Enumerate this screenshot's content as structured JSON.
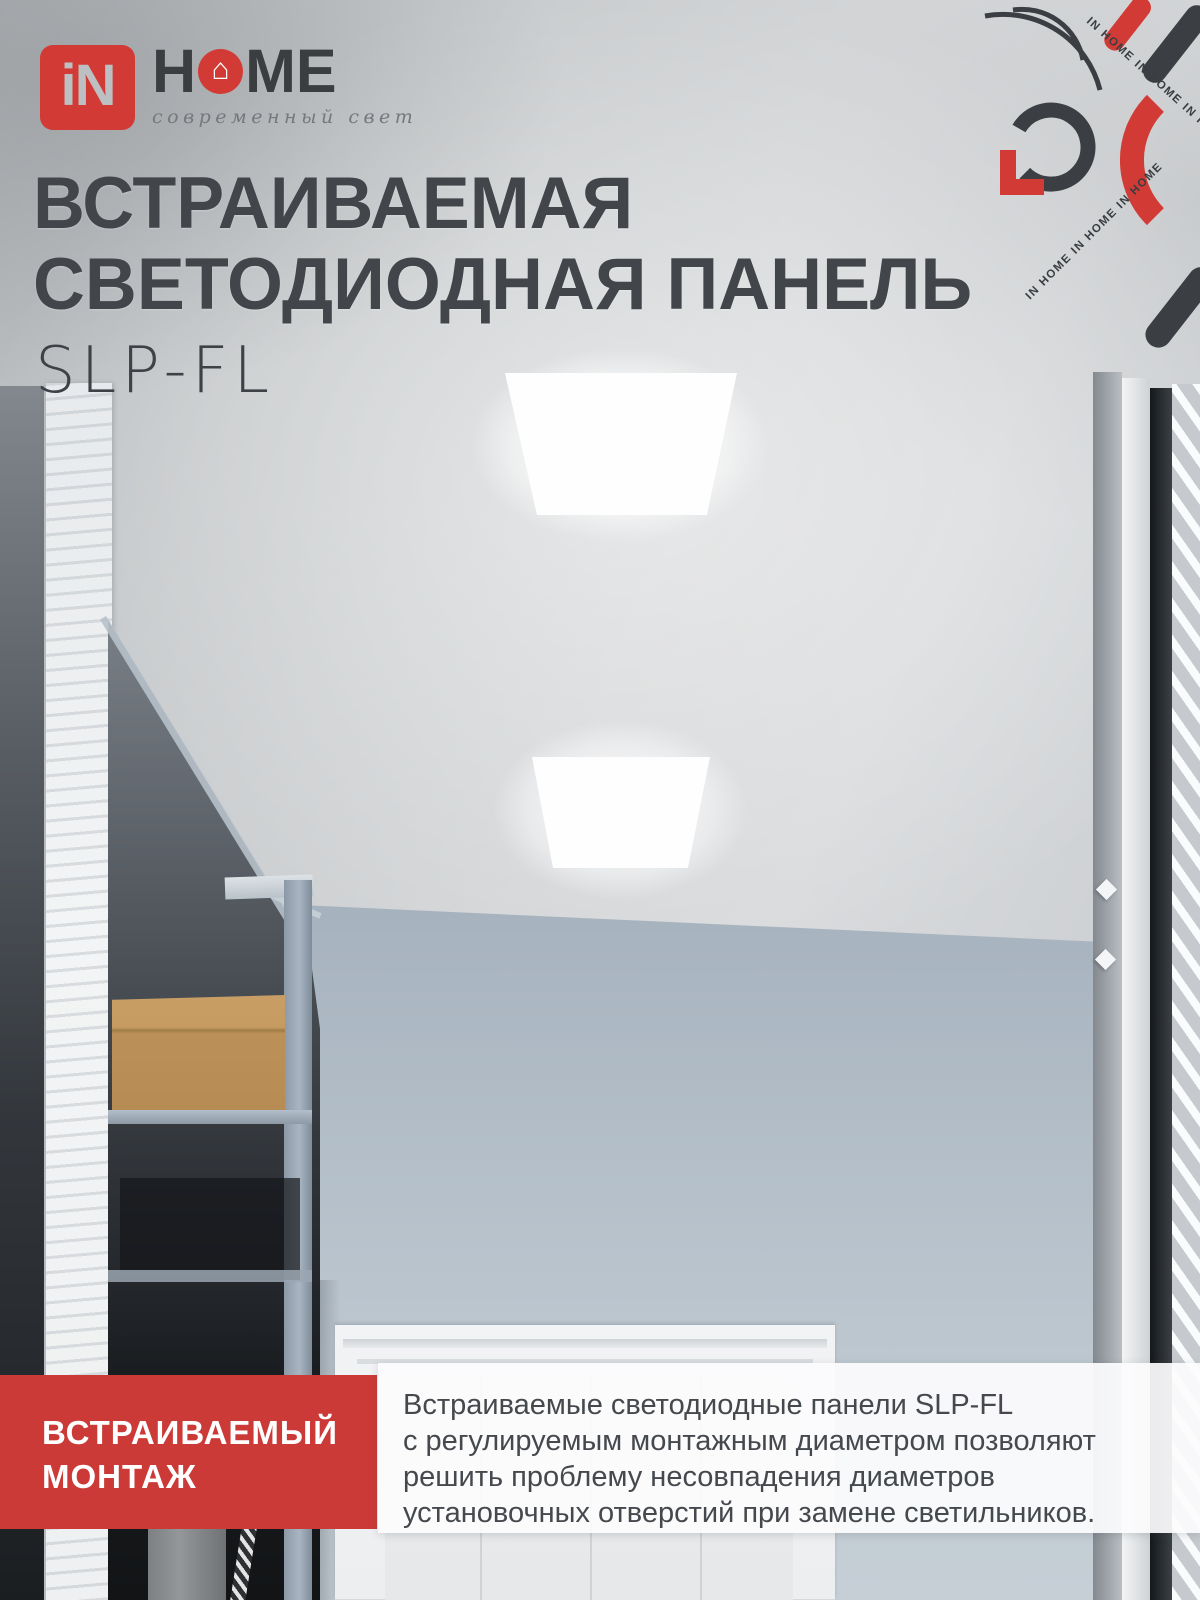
{
  "colors": {
    "brand_red": "#d23b35",
    "badge_red": "#cb3a37",
    "dark_text": "#42464a"
  },
  "brand": {
    "mark_text": "iN",
    "home_h": "H",
    "home_me": "ME",
    "house_icon": "⌂",
    "tagline": "современный свет"
  },
  "hero": {
    "title_line1": "ВСТРАИВАЕМАЯ",
    "title_line2": "СВЕТОДИОДНАЯ ПАНЕЛЬ",
    "model": "SLP-FL"
  },
  "decor": {
    "watermark_line1": "IN HOME  IN HOME  IN HOME",
    "watermark_line2": "IN HOME  IN HOME  IN HOME"
  },
  "footer": {
    "badge_line1": "ВСТРАИВАЕМЫЙ",
    "badge_line2": "МОНТАЖ",
    "description_lines": [
      "Встраиваемые светодиодные панели SLP-FL",
      "с регулируемым монтажным диаметром позволяют",
      "решить проблему несовпадения диаметров",
      "установочных отверстий при замене светильников."
    ]
  }
}
